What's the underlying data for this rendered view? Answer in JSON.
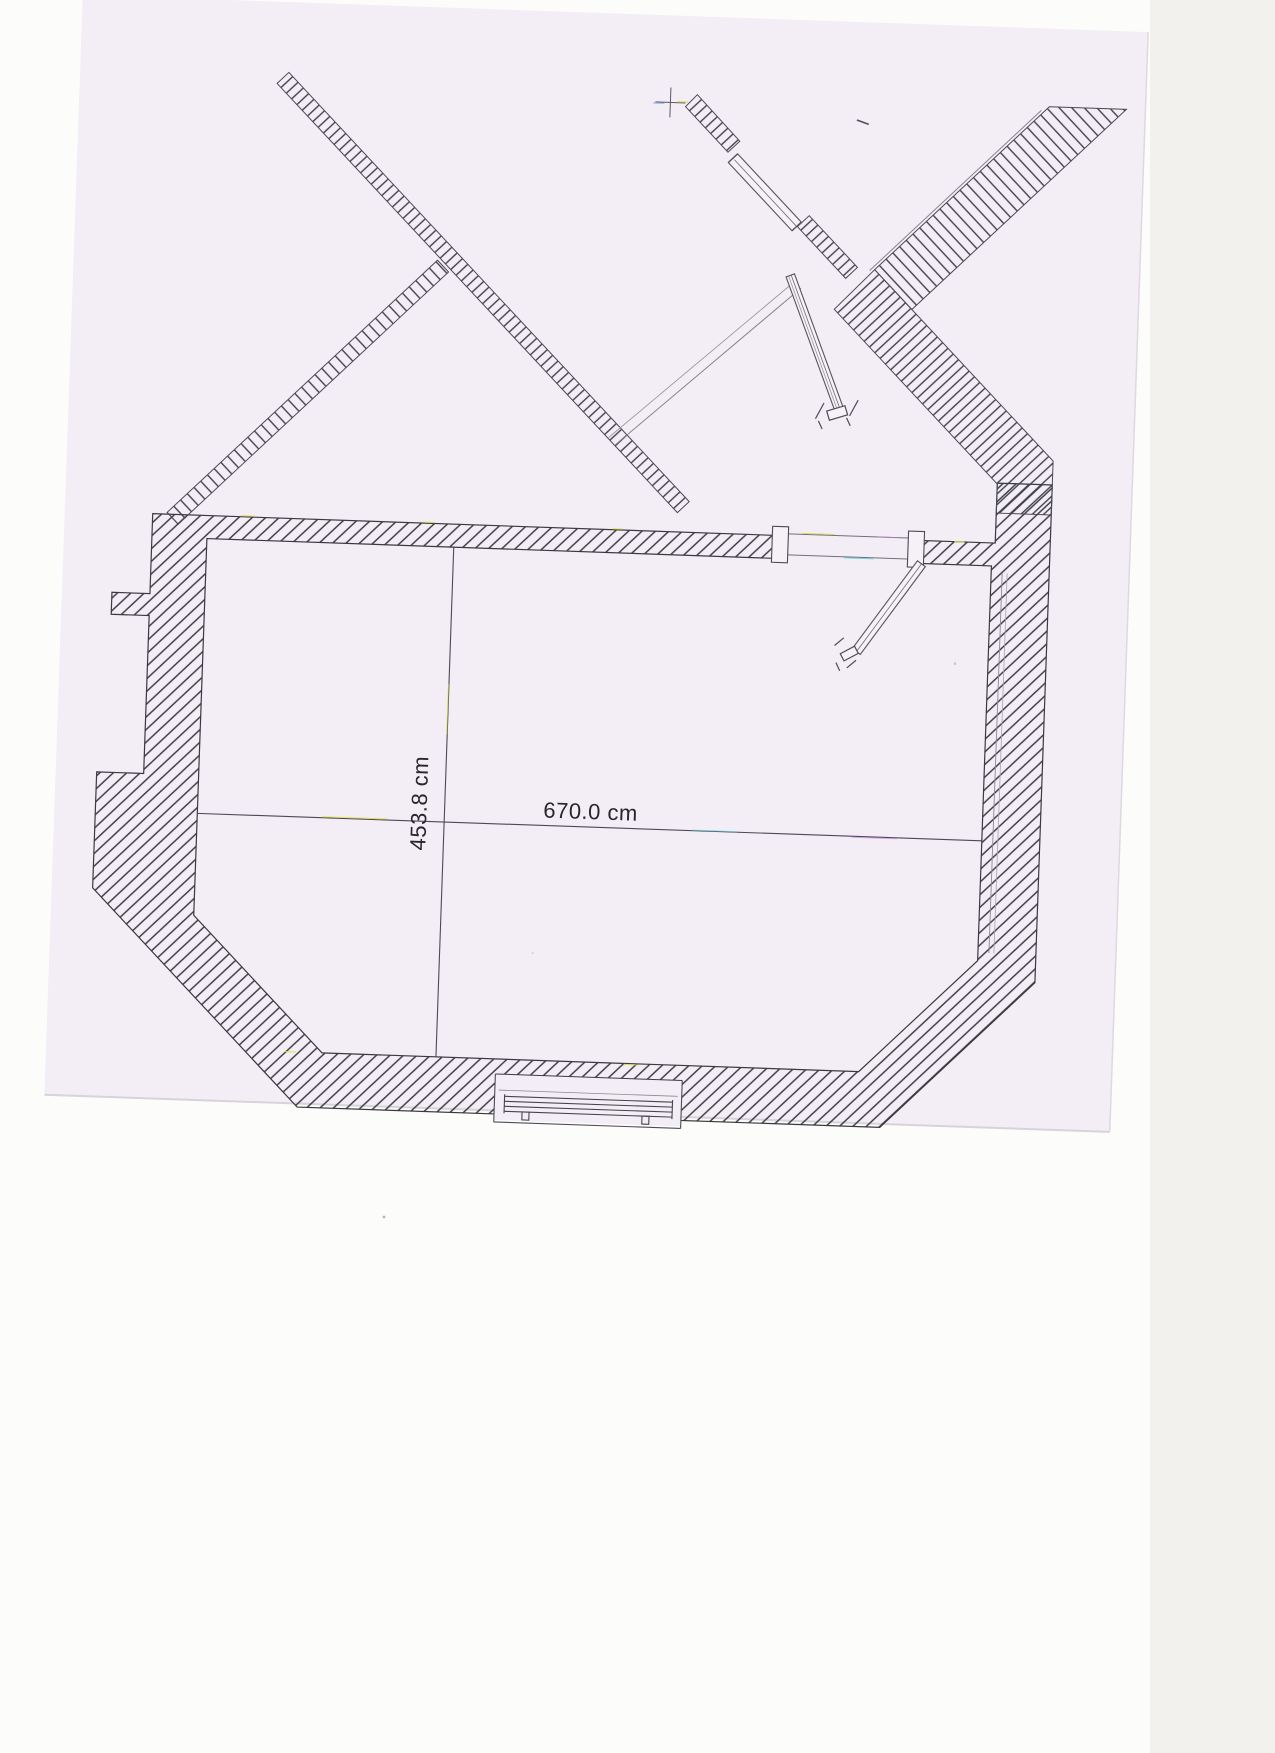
{
  "document": {
    "type": "scanned-floor-plan",
    "description": "Scanned CAD floor plan of a room with hatched walls, stair flights, door symbols and a window radiator",
    "paper_color": "#f3edf5",
    "background_color": "#fcfcfa",
    "line_color": "#3c3c44",
    "dimension_line_color": "#4a4a58"
  },
  "dimensions": {
    "width_label": "670.0 cm",
    "height_label": "453.8 cm",
    "unit": "cm",
    "width_value": 670.0,
    "height_value": 453.8
  },
  "symbols": {
    "stair_flights": 5,
    "doors": 3,
    "window_radiator": 1,
    "registration_cross": 1
  }
}
